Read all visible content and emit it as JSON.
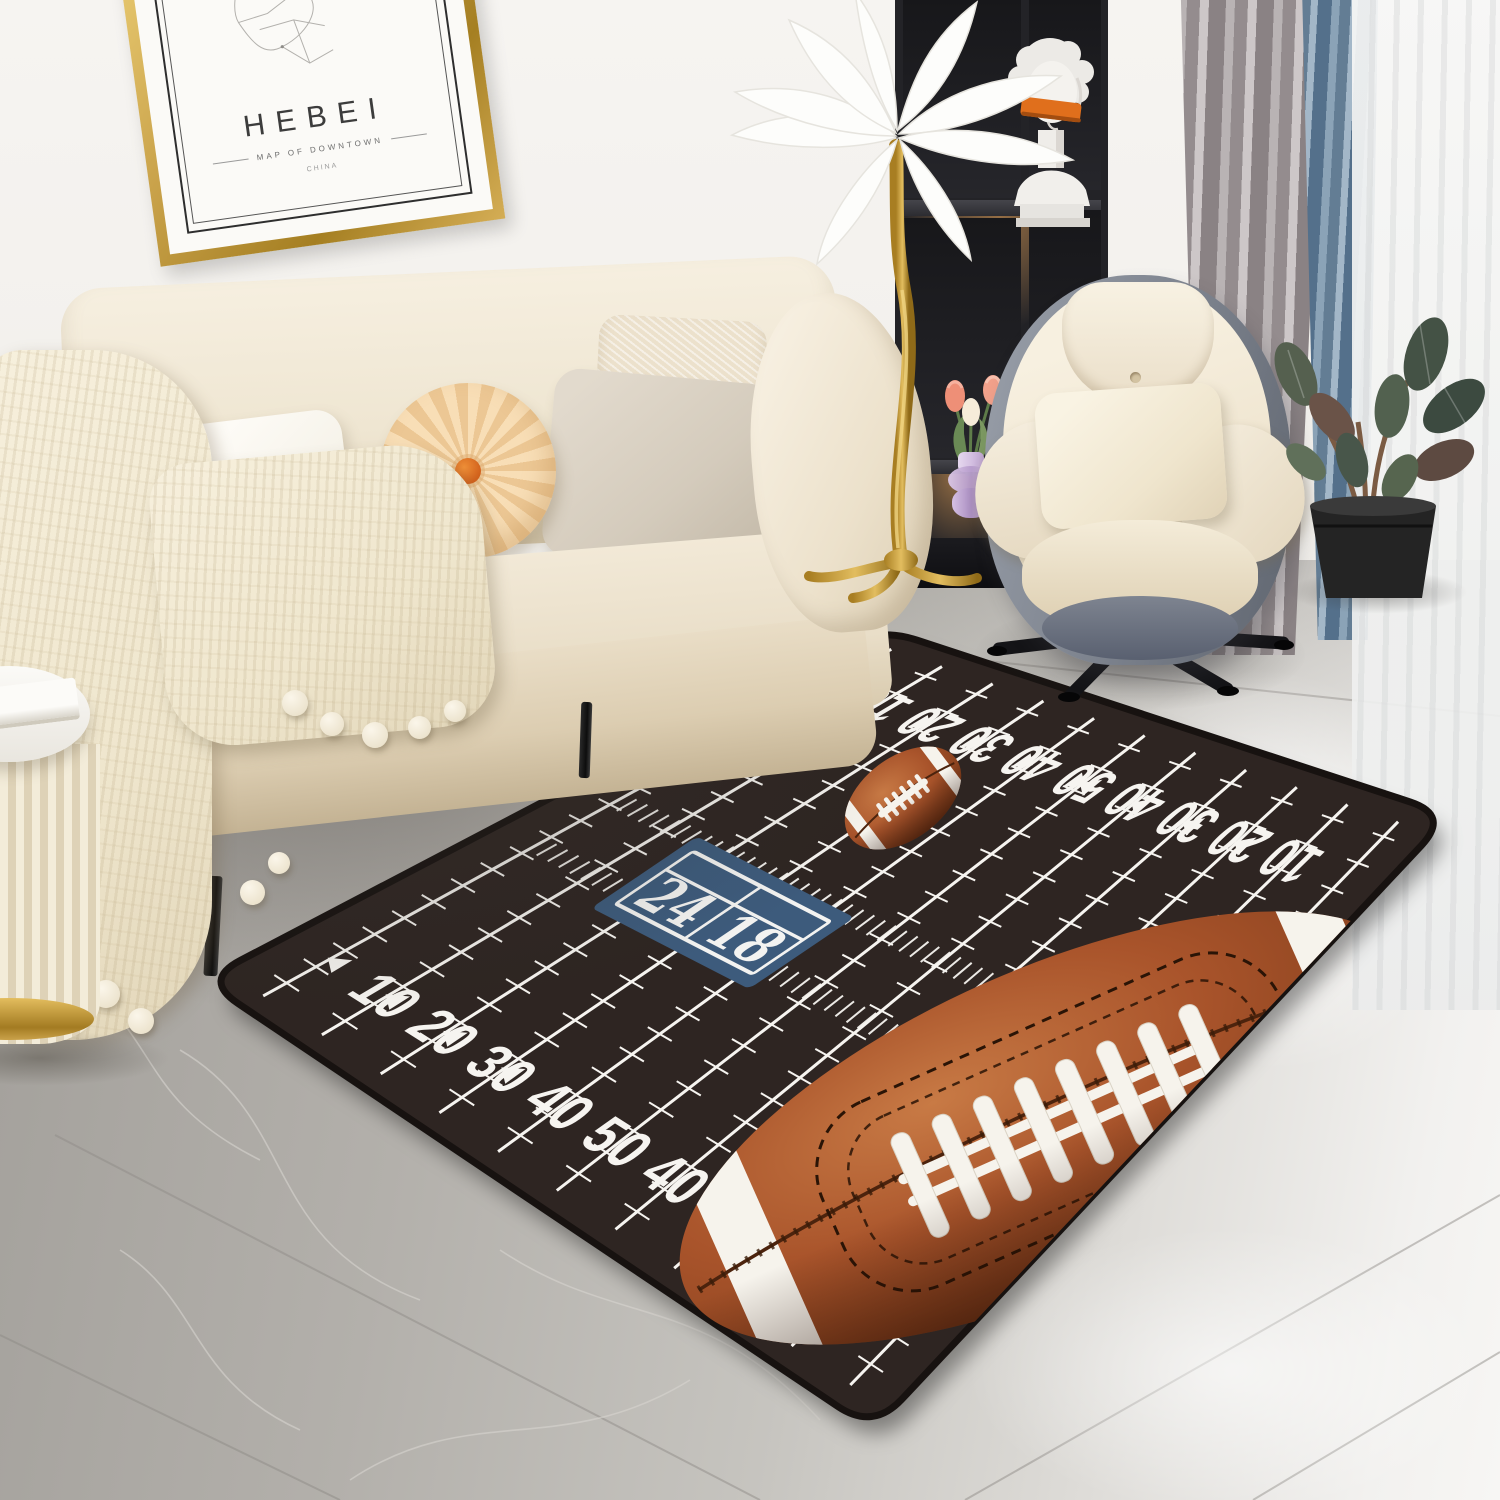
{
  "wall_art": {
    "title": "HEBEI",
    "subtitle": "MAP OF DOWNTOWN",
    "caption": "CHINA"
  },
  "shelf": {
    "book_title": "Union"
  },
  "palette": {
    "wall": "#f3f1ed",
    "floor_dark": "#a29f9a",
    "floor_light": "#f7f6f4",
    "sofa_cream": "#efe6d2",
    "chair_shell_gray": "#7b818c",
    "gold": "#c9a24a",
    "curtain_gray": "#948c8e",
    "curtain_blue": "#637d94"
  },
  "rug": {
    "field_color": "#2e2522",
    "edge_color": "#171210",
    "line_color": "#f6f4f0",
    "corners": {
      "T": [
        877,
        627
      ],
      "R": [
        1450,
        815
      ],
      "B": [
        873,
        1430
      ],
      "L": [
        203,
        980
      ]
    },
    "yard_numbers": [
      "10",
      "20",
      "30",
      "40",
      "50",
      "40",
      "30",
      "20",
      "10"
    ],
    "scoreboard": {
      "left_score": "24",
      "right_score": "18",
      "panel_color": "#3d5b7c",
      "text_color": "#f3f3f1",
      "u": 0.315,
      "v": 0.52
    },
    "balls": {
      "leather_light": "#c87a45",
      "leather_mid": "#a9542b",
      "leather_dark": "#6b3012",
      "lace_color": "#f6f3ec",
      "stitch_color": "#2a1406"
    }
  }
}
